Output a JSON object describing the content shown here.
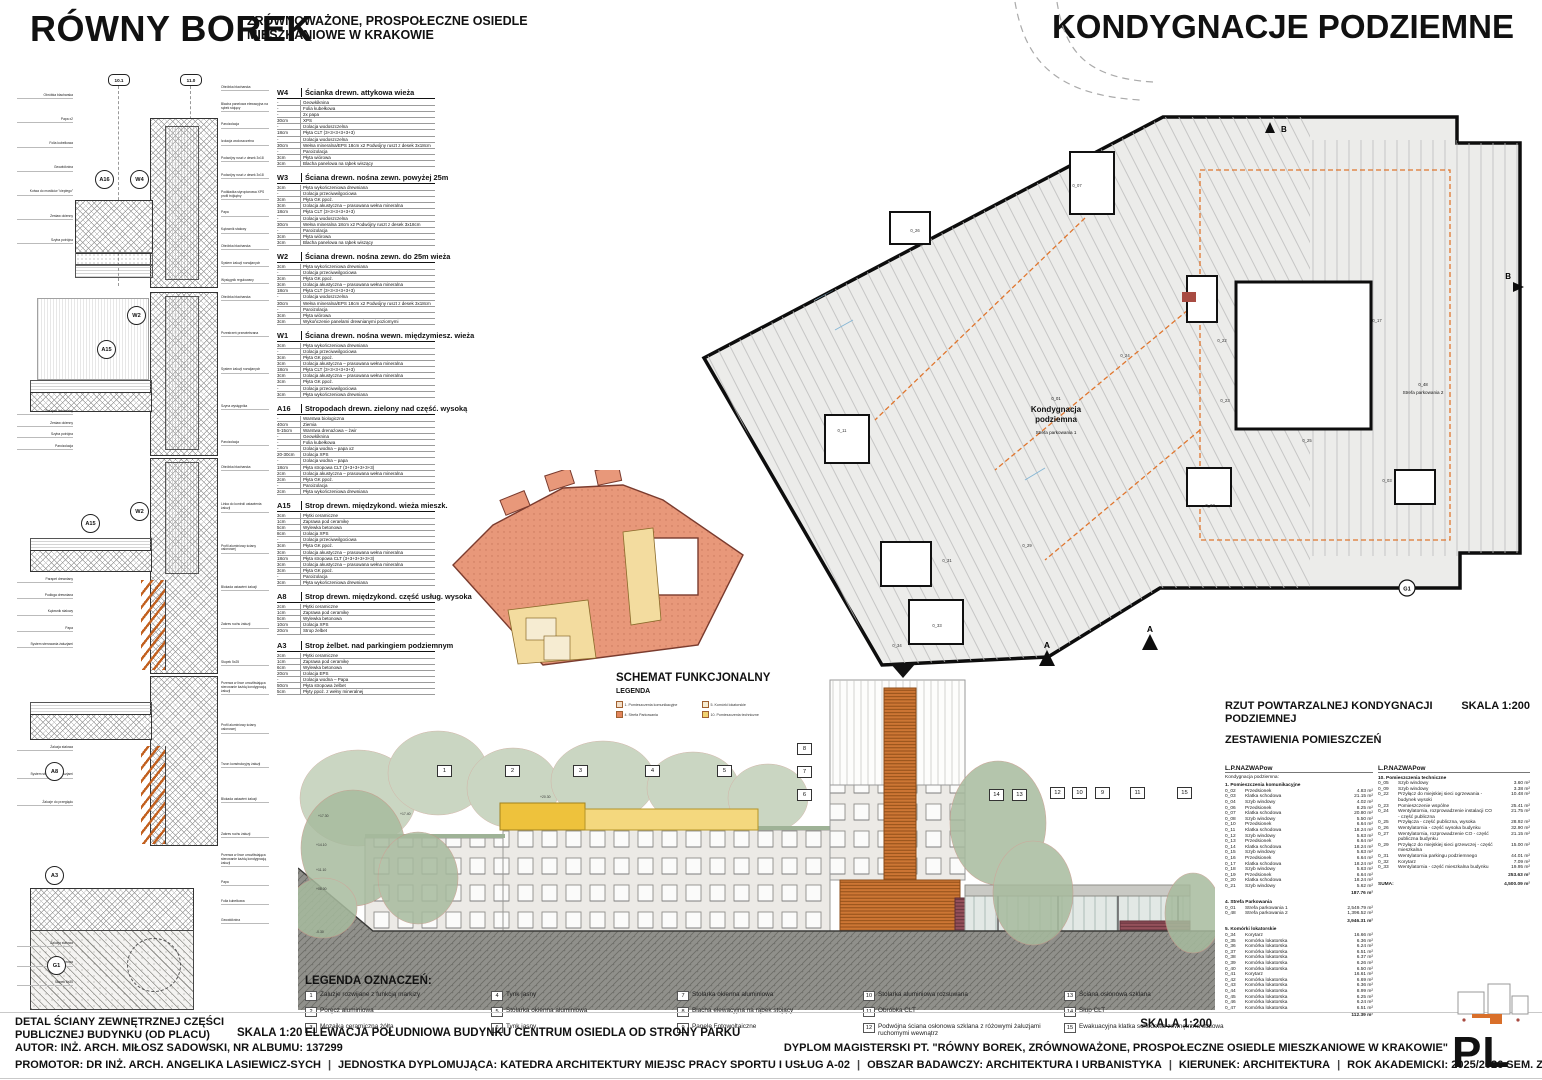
{
  "header": {
    "title": "RÓWNY BOREK",
    "subtitle_line1": "ZRÓWNOWAŻONE, PROSPOŁECZNE OSIEDLE",
    "subtitle_line2": "MIESZKANIOWE W KRAKOWIE",
    "sheet_title": "KONDYGNACJE PODZIEMNE"
  },
  "details": {
    "grid_bubbles": [
      "10.1",
      "11.0"
    ],
    "panels": [
      {
        "bubbles": [
          "A16",
          "W4"
        ],
        "left": [
          "Obróbka blacharska",
          "Papa x2",
          "Folia kubełkowa",
          "Geowłóknina",
          "Kotwa do mostków \"ciepłego\"",
          "Zestaw okienny",
          "Szyba potrójna"
        ],
        "right": [
          "Obróbka blacharska",
          "Blacha panelowa elewacyjna na rąbek stojący",
          "Paroizolacja",
          "Izolacja wodoszczelna",
          "Podwójny ruszt z desek 3x18",
          "Podwójny ruszt z desek 3x18",
          "Podkładka styropianowa XPS profil trójkątny",
          "Papa",
          "Kątownik stalowy",
          "Obróbka blacharska",
          "System żaluzji rozwijanych",
          "Wysięgnik regulowany"
        ]
      },
      {
        "bubbles": [
          "W2",
          "A15"
        ],
        "left": [
          "Parapet drewniany",
          "Zestaw okienny",
          "Szyba potrójna",
          "Paroizolacja"
        ],
        "right": [
          "Obróbka blacharska",
          "Przestrzeń przewietrzana",
          "System żaluzji rozwijanych",
          "Szyna wysięgnika",
          "Paroizolacja"
        ]
      },
      {
        "bubbles": [
          "A15",
          "W2"
        ],
        "left": [
          "Parapet drewniany",
          "Podłoga drewniana",
          "Kątownik stalowy",
          "Papa",
          "System sterowania żaluzjami"
        ],
        "right": [
          "Obróbka blacharska",
          "Linka do kontroli ustawienia żaluzji",
          "Profil aluminiowy ściany osłonowej",
          "Blokada ustawień żaluzji",
          "Zakres ruchu żaluzji",
          "Słupek 5x25"
        ]
      },
      {
        "bubbles": [
          "A8"
        ],
        "left": [
          "Żaluzja stalowa",
          "System sterowania żaluzjami",
          "Żaluzje do przeglądu"
        ],
        "right": [
          "Przerwa w lince umożliwiająca sterowanie każdą kondygnacją żaluzji",
          "Profil aluminiowy ściany osłonowej",
          "Trzon konstrukcyjny żaluzji",
          "Blokada ustawień żaluzji",
          "Zakres ruchu żaluzji"
        ]
      },
      {
        "bubbles": [
          "A3",
          "G1"
        ],
        "left": [
          "Żaluzja stalowa",
          "Podłoga ażurowa",
          "Słupek 5x25"
        ],
        "right": [
          "Przerwa w lince umożliwiająca sterowanie każdą kondygnacją żaluzji",
          "Papa",
          "Folia kubełkowa",
          "Geowłóknina"
        ]
      }
    ]
  },
  "assemblies": [
    {
      "code": "W4",
      "title": "Ścianka drewn. attykowa wieża",
      "rows": [
        [
          "-",
          "Geowłóknina"
        ],
        [
          "-",
          "Folia kubełkowa"
        ],
        [
          "-",
          "2x papa"
        ],
        [
          "30cm",
          "XPS"
        ],
        [
          "-",
          "Izolacja wodoszczelna"
        ],
        [
          "18cm",
          "Płyta CLT (3+3+3+3+3+3)"
        ],
        [
          "-",
          "Izolacja wodoszczelna"
        ],
        [
          "30cm",
          "Wełna mineralna/EPS   18cm x2   Podwójny ruszt z desek 3x18cm"
        ],
        [
          "-",
          "Paroizolacja"
        ],
        [
          "3cm",
          "Płyta wiórowa"
        ],
        [
          "3cm",
          "Blacha panelowa na rąbek wiszący"
        ]
      ]
    },
    {
      "code": "W3",
      "title": "Ściana drewn. nośna zewn. powyżej 25m",
      "rows": [
        [
          "3cm",
          "Płyta wykończeniowa drewniana"
        ],
        [
          "-",
          "Izolacja przeciwwilgociowa"
        ],
        [
          "3cm",
          "Płyta GK ppoż."
        ],
        [
          "3cm",
          "Izolacja akustyczna – prasowana wełna mineralna"
        ],
        [
          "18cm",
          "Płyta CLT (3+3+3+3+3+3)"
        ],
        [
          "-",
          "Izolacja wodoszczelna"
        ],
        [
          "30cm",
          "Wełna mineralna   18cm x2   Podwójny ruszt z desek 3x18cm"
        ],
        [
          "-",
          "Paroizolacja"
        ],
        [
          "3cm",
          "Płyta wiórowa"
        ],
        [
          "3cm",
          "Blacha panelowa na rąbek wiszący"
        ]
      ]
    },
    {
      "code": "W2",
      "title": "Ściana drewn. nośna zewn. do 25m wieża",
      "rows": [
        [
          "3cm",
          "Płyta wykończeniowa drewniana"
        ],
        [
          "-",
          "Izolacja przeciwwilgociowa"
        ],
        [
          "3cm",
          "Płyta GK ppoż."
        ],
        [
          "3cm",
          "Izolacja akustyczna – prasowana wełna mineralna"
        ],
        [
          "18cm",
          "Płyta CLT (3+3+3+3+3+3)"
        ],
        [
          "-",
          "Izolacja wodoszczelna"
        ],
        [
          "30cm",
          "Wełna mineralna/EPS   18cm x2   Podwójny ruszt z desek 3x18cm"
        ],
        [
          "-",
          "Paroizolacja"
        ],
        [
          "3cm",
          "Płyta wiórowa"
        ],
        [
          "3cm",
          "Wykończenie panelami drewnianymi poziomymi"
        ]
      ]
    },
    {
      "code": "W1",
      "title": "Ściana drewn. nośna wewn. międzymiesz. wieża",
      "rows": [
        [
          "3cm",
          "Płyta wykończeniowa drewniana"
        ],
        [
          "-",
          "Izolacja przeciwwilgociowa"
        ],
        [
          "3cm",
          "Płyta GK ppoż."
        ],
        [
          "3cm",
          "Izolacja akustyczna – prasowana wełna mineralna"
        ],
        [
          "18cm",
          "Płyta CLT (3+3+3+3+3+3)"
        ],
        [
          "3cm",
          "Izolacja akustyczna – prasowana wełna mineralna"
        ],
        [
          "3cm",
          "Płyta GK ppoż."
        ],
        [
          "-",
          "Izolacja przeciwwilgociowa"
        ],
        [
          "3cm",
          "Płyta wykończeniowa drewniana"
        ]
      ]
    },
    {
      "code": "A16",
      "title": "Stropodach drewn. zielony nad część. wysoką",
      "rows": [
        [
          "-",
          "Warstwa biologiczna"
        ],
        [
          "40cm",
          "Ziemia"
        ],
        [
          "5-15cm",
          "Warstwa drenażowa – żwir"
        ],
        [
          "-",
          "Geowłóknina"
        ],
        [
          "-",
          "Folia kubełkowa"
        ],
        [
          "-",
          "Izolacja wodna – papa x2"
        ],
        [
          "20-30cm",
          "Izolacja XPS"
        ],
        [
          "-",
          "Izolacja wodna – papa"
        ],
        [
          "18cm",
          "Płyta stropowa CLT (3+3+3+3+3+3)"
        ],
        [
          "2cm",
          "Izolacja akustyczna – prasowana wełna mineralna"
        ],
        [
          "2cm",
          "Płyta GK ppoż."
        ],
        [
          "-",
          "Paroizolacja"
        ],
        [
          "2cm",
          "Płyta wykończeniowa drewniana"
        ]
      ]
    },
    {
      "code": "A15",
      "title": "Strop drewn. międzykond. wieża mieszk.",
      "rows": [
        [
          "3cm",
          "Płytki ceramiczne"
        ],
        [
          "1cm",
          "Zaprawa pod ceramikę"
        ],
        [
          "5cm",
          "Wylewka betonowa"
        ],
        [
          "8cm",
          "Izolacja XPS"
        ],
        [
          "-",
          "Izolacja przeciwwilgociowa"
        ],
        [
          "3cm",
          "Płyta GK ppoż."
        ],
        [
          "3cm",
          "Izolacja akustyczna – prasowana wełna mineralna"
        ],
        [
          "18cm",
          "Płyta stropowa CLT (3+3+3+3+3+3)"
        ],
        [
          "3cm",
          "Izolacja akustyczna – prasowana wełna mineralna"
        ],
        [
          "3cm",
          "Płyta GK ppoż."
        ],
        [
          "-",
          "Paroizolacja"
        ],
        [
          "3cm",
          "Płyta wykończeniowa drewniana"
        ]
      ]
    },
    {
      "code": "A8",
      "title": "Strop drewn. międzykond. część usług. wysoka",
      "rows": [
        [
          "2cm",
          "Płytki ceramiczne"
        ],
        [
          "1cm",
          "Zaprawa pod ceramikę"
        ],
        [
          "5cm",
          "Wylewka betonowa"
        ],
        [
          "10cm",
          "Izolacja XPS"
        ],
        [
          "20cm",
          "Strop żelbet"
        ]
      ]
    },
    {
      "code": "A3",
      "title": "Strop żelbet. nad parkingiem podziemnym",
      "rows": [
        [
          "2cm",
          "Płytki ceramiczne"
        ],
        [
          "1cm",
          "Zaprawa pod ceramikę"
        ],
        [
          "6cm",
          "Wylewka betonowa"
        ],
        [
          "20cm",
          "Izolacja EPS"
        ],
        [
          "-",
          "Izolacja wodna – Papa"
        ],
        [
          "50cm",
          "Płyta stropowa żelbet"
        ],
        [
          "5cm",
          "Płyty ppoż. z wełny mineralnej"
        ]
      ]
    }
  ],
  "schemat": {
    "title": "SCHEMAT FUNKCJONALNY",
    "legend_title": "LEGENDA",
    "items": [
      {
        "label": "1. Pomieszczenia komunikacyjne",
        "color": "#f2dfc9"
      },
      {
        "label": "4. Strefa Parkowania",
        "color": "#e2855c"
      },
      {
        "label": "5. Komórki lokatorskie",
        "color": "#f6ecd2"
      },
      {
        "label": "10. Pomieszczenia techniczne",
        "color": "#f0d270"
      }
    ]
  },
  "plan": {
    "code": "0_01",
    "label_line1": "Kondygnacja",
    "label_line2": "podziemna",
    "label_sub": "Strefa parkowania 1",
    "zone2_code": "0_48",
    "zone2_label": "Strefa parkowania 2",
    "marker_b": "B",
    "marker_a": "A",
    "marker_g1": "G1",
    "room_codes": [
      {
        "t": "0_26",
        "x": 220,
        "y": 232
      },
      {
        "t": "0_22",
        "x": 527,
        "y": 342
      },
      {
        "t": "0_23",
        "x": 530,
        "y": 402
      },
      {
        "t": "0_24",
        "x": 430,
        "y": 357
      },
      {
        "t": "0_25",
        "x": 612,
        "y": 442
      },
      {
        "t": "0_27",
        "x": 515,
        "y": 507
      },
      {
        "t": "0_29",
        "x": 332,
        "y": 547
      },
      {
        "t": "0_31",
        "x": 252,
        "y": 562
      },
      {
        "t": "0_33",
        "x": 242,
        "y": 627
      },
      {
        "t": "0_34",
        "x": 202,
        "y": 647
      },
      {
        "t": "0_07",
        "x": 382,
        "y": 187
      },
      {
        "t": "0_11",
        "x": 147,
        "y": 432
      },
      {
        "t": "0_17",
        "x": 682,
        "y": 322
      },
      {
        "t": "0_03",
        "x": 692,
        "y": 482
      }
    ]
  },
  "elevation": {
    "markers_top": [
      "1",
      "2",
      "3",
      "4",
      "5"
    ],
    "markers_left": [
      "8",
      "7",
      "6"
    ],
    "markers_right": [
      "14",
      "13",
      "12",
      "10",
      "9",
      "11",
      "15"
    ],
    "levels": [
      {
        "t": "+17.30",
        "x": 318,
        "y": 814
      },
      {
        "t": "+17.40",
        "x": 400,
        "y": 812
      },
      {
        "t": "+20.30",
        "x": 540,
        "y": 795
      },
      {
        "t": "+14.10",
        "x": 316,
        "y": 843
      },
      {
        "t": "+11.10",
        "x": 316,
        "y": 868
      },
      {
        "t": "+08.00",
        "x": 316,
        "y": 887
      },
      {
        "t": "-0.30",
        "x": 316,
        "y": 930
      }
    ],
    "scale": "SKALA 1:200"
  },
  "room_table": {
    "heading_line1": "RZUT POWTARZALNEJ KONDYGNACJI",
    "heading_line2": "PODZIEMNEJ",
    "scale": "SKALA 1:200",
    "subheading": "ZESTAWIENIA POMIESZCZEŃ",
    "col_lp": "L.P.",
    "col_nazwa": "NAZWA",
    "col_pow": "Pow",
    "group": "Kondygnacja podziemna:",
    "left_sections": [
      {
        "name": "1. Pomieszczenia komunikacyjne",
        "total": "187.76 m²",
        "rows": [
          [
            "0_02",
            "Przedsionek",
            "4.83 m²"
          ],
          [
            "0_03",
            "Klatka schodowa",
            "21.15 m²"
          ],
          [
            "0_04",
            "Szyb windowy",
            "4.02 m²"
          ],
          [
            "0_06",
            "Przedsionek",
            "8.25 m²"
          ],
          [
            "0_07",
            "Klatka schodowa",
            "20.80 m²"
          ],
          [
            "0_08",
            "Szyb windowy",
            "5.50 m²"
          ],
          [
            "0_10",
            "Przedsionek",
            "6.64 m²"
          ],
          [
            "0_11",
            "Klatka schodowa",
            "18.24 m²"
          ],
          [
            "0_12",
            "Szyb windowy",
            "5.63 m²"
          ],
          [
            "0_13",
            "Przedsionek",
            "6.64 m²"
          ],
          [
            "0_14",
            "Klatka schodowa",
            "18.24 m²"
          ],
          [
            "0_15",
            "Szyb windowy",
            "5.63 m²"
          ],
          [
            "0_16",
            "Przedsionek",
            "6.64 m²"
          ],
          [
            "0_17",
            "Klatka schodowa",
            "18.24 m²"
          ],
          [
            "0_18",
            "Szyb windowy",
            "5.63 m²"
          ],
          [
            "0_19",
            "Przedsionek",
            "6.64 m²"
          ],
          [
            "0_20",
            "Klatka schodowa",
            "18.24 m²"
          ],
          [
            "0_21",
            "Szyb windowy",
            "5.62 m²"
          ]
        ]
      },
      {
        "name": "4. Strefa Parkowania",
        "total": "3,946.31 m²",
        "rows": [
          [
            "0_01",
            "Strefa parkowania 1",
            "2,549.79 m²"
          ],
          [
            "0_48",
            "Strefa parkowania 2",
            "1,396.52 m²"
          ]
        ]
      },
      {
        "name": "5. Komórki lokatorskie",
        "total": "112.39 m²",
        "rows": [
          [
            "0_34",
            "Korytarz",
            "16.66 m²"
          ],
          [
            "0_35",
            "Komórka lokatorska",
            "6.36 m²"
          ],
          [
            "0_36",
            "Komórka lokatorska",
            "6.24 m²"
          ],
          [
            "0_37",
            "Komórka lokatorska",
            "6.51 m²"
          ],
          [
            "0_38",
            "Komórka lokatorska",
            "6.37 m²"
          ],
          [
            "0_39",
            "Komórka lokatorska",
            "6.26 m²"
          ],
          [
            "0_40",
            "Komórka lokatorska",
            "6.50 m²"
          ],
          [
            "0_41",
            "Korytarz",
            "16.61 m²"
          ],
          [
            "0_42",
            "Komórka lokatorska",
            "6.69 m²"
          ],
          [
            "0_43",
            "Komórka lokatorska",
            "6.36 m²"
          ],
          [
            "0_44",
            "Komórka lokatorska",
            "8.99 m²"
          ],
          [
            "0_45",
            "Komórka lokatorska",
            "6.25 m²"
          ],
          [
            "0_46",
            "Komórka lokatorska",
            "6.24 m²"
          ],
          [
            "0_47",
            "Komórka lokatorska",
            "6.51 m²"
          ]
        ]
      }
    ],
    "right_sections": [
      {
        "name": "10. Pomieszczenia techniczne",
        "total": "253.63 m²",
        "rows": [
          [
            "0_05",
            "Szyb windowy",
            "3.60 m²"
          ],
          [
            "0_09",
            "Szyb windowy",
            "3.38 m²"
          ],
          [
            "0_22",
            "Przyłącz do miejskiej sieci ogrzewania - budynek wysoki",
            "10.48 m²"
          ],
          [
            "0_23",
            "Pomieszczenie wspólne",
            "25.41 m²"
          ],
          [
            "0_24",
            "Wentylatornia, rozprowadzenie instalacji CO - część publiczna",
            "21.75 m²"
          ],
          [
            "0_25",
            "Przyłącza - część publiczna, wysoka",
            "28.92 m²"
          ],
          [
            "0_26",
            "Wentylatornia - część wysoka budynku",
            "32.90 m²"
          ],
          [
            "0_27",
            "Wentylatornia, rozprowadzenie CO - część publiczna budynku",
            "21.15 m²"
          ],
          [
            "0_29",
            "Przyłącz do miejskiej sieci grzewczej - część mieszkalna",
            "15.00 m²"
          ],
          [
            "0_31",
            "Wentylatornia parkingu podziemnego",
            "44.01 m²"
          ],
          [
            "0_32",
            "Korytarz",
            "7.09 m²"
          ],
          [
            "0_33",
            "Wentylatornia - część mieszkalna budynku",
            "19.95 m²"
          ]
        ]
      }
    ],
    "suma_label": "SUMA:",
    "suma_value": "4,500.09 m²"
  },
  "legend": {
    "title": "LEGENDA OZNACZEŃ:",
    "items": [
      {
        "num": "1",
        "label": "Żaluzje rozwijane z funkcją markizy"
      },
      {
        "num": "2",
        "label": "Poręcz aluminiowa"
      },
      {
        "num": "3",
        "label": "Mozaika ceramiczna żółta"
      },
      {
        "num": "4",
        "label": "Tynk jasny"
      },
      {
        "num": "5",
        "label": "Stolarka okienna aluminiowa"
      },
      {
        "num": "6",
        "label": "Tynk jasny"
      },
      {
        "num": "7",
        "label": "Stolarka okienna aluminiowa"
      },
      {
        "num": "8",
        "label": "Blacha elewacyjna na rąbek stojący"
      },
      {
        "num": "9",
        "label": "Panele Fotowoltaiczne"
      },
      {
        "num": "10",
        "label": "Stolarka aluminiowa rozsuwana"
      },
      {
        "num": "11",
        "label": "Obróbka CLT"
      },
      {
        "num": "12",
        "label": "Podwójna ściana osłonowa szklana z różowymi żaluzjami ruchomymi wewnątrz"
      },
      {
        "num": "13",
        "label": "Ściana osłonowa szklana"
      },
      {
        "num": "14",
        "label": "Słup CLT"
      },
      {
        "num": "15",
        "label": "Ewakuacyjna klatka schodowa zewnętrzna stalowa"
      }
    ]
  },
  "captions": {
    "detail_line1": "DETAL ŚCIANY ZEWNĘTRZNEJ CZĘŚCI",
    "detail_line2": "PUBLICZNEJ BUDYNKU (OD PLACU)",
    "detail_scale": "SKALA 1:20",
    "elevation_caption": "ELEWACJA POŁUDNIOWA BUDYNKU CENTRUM OSIEDLA OD STRONY PARKU",
    "elevation_scale": "SKALA 1:200"
  },
  "footer": {
    "author": "AUTOR: INŻ. ARCH. MIŁOSZ SADOWSKI, NR ALBUMU: 137299",
    "diploma": "DYPLOM MAGISTERSKI PT. \"RÓWNY BOREK, ZRÓWNOWAŻONE, PROSPOŁECZNE OSIEDLE MIESZKANIOWE W KRAKOWIE\"",
    "line2_parts": [
      "PROMOTOR: DR INŻ. ARCH. ANGELIKA LASIEWICZ-SYCH",
      "JEDNOSTKA DYPLOMUJĄCA: KATEDRA ARCHITEKTURY MIEJSC PRACY SPORTU I USŁUG A-02",
      "OBSZAR BADAWCZY: ARCHITEKTURA I URBANISTYKA",
      "KIERUNEK: ARCHITEKTURA",
      "ROK AKADEMICKI: 2025/2026 SEM. ZIMOWY"
    ],
    "sheet_number": "PL 8"
  }
}
